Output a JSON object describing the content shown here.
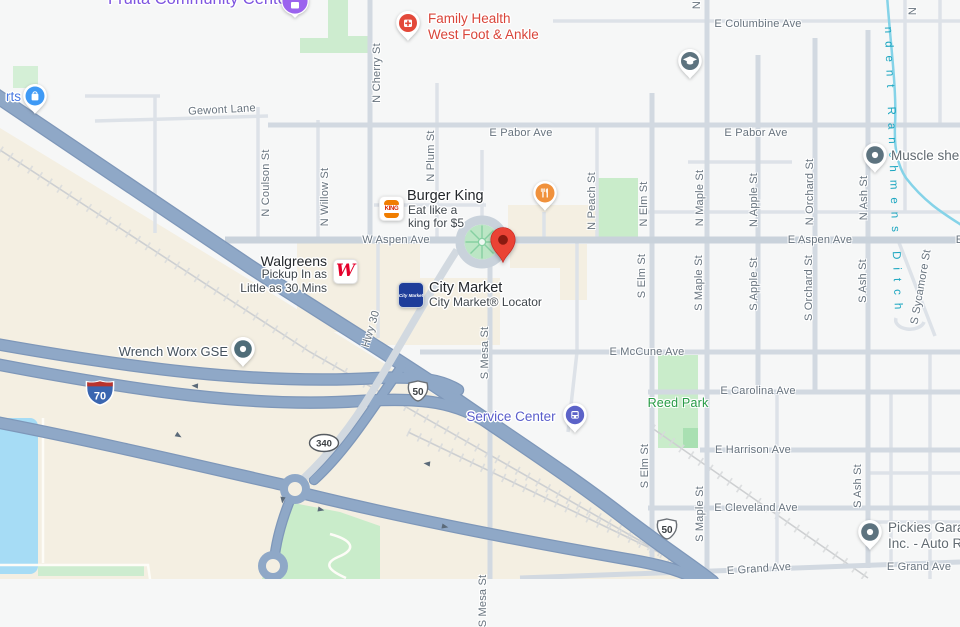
{
  "map": {
    "colors": {
      "destination_pin": "#ea4335",
      "highway": "#8fa8c7",
      "water": "#a6dcf5",
      "park": "#c9ecca",
      "purple_poi": "#7e55e0",
      "red_poi": "#d9453a",
      "transit_poi": "#5a5ecb",
      "park_label": "#279b45",
      "ditch": "#1ba6c0"
    },
    "pois": {
      "fruita": {
        "name": "Fruita Community Center"
      },
      "family_health": {
        "line1": "Family Health",
        "line2": "West Foot & Ankle"
      },
      "muscle": {
        "name": "Muscle she"
      },
      "parts": {
        "name": "rts"
      },
      "burger_king": {
        "name": "Burger King",
        "promo1": "Eat like a",
        "promo2": "king for $5",
        "logo_word": "KING"
      },
      "walgreens": {
        "name": "Walgreens",
        "promo1": "Pickup In as",
        "promo2": "Little as 30 Mins",
        "logo_letter": "W"
      },
      "city_market": {
        "name": "City Market",
        "sub": "City Market® Locator",
        "logo_word": "City Market"
      },
      "wrench": {
        "name": "Wrench Worx GSE"
      },
      "service_center": {
        "name": "Service Center"
      },
      "pickies": {
        "line1": "Pickies Gara",
        "line2": "Inc. - Auto R"
      },
      "reed_park": {
        "name": "Reed Park"
      }
    },
    "shields": {
      "i70": "70",
      "us50": "50",
      "co340": "340"
    },
    "waterway": {
      "name": "ndent Ranchmens Ditch"
    },
    "street_labels": [
      {
        "t": "N Coulson St",
        "x": 266,
        "y": 183
      },
      {
        "t": "N Willow St",
        "x": 325,
        "y": 197
      },
      {
        "t": "N Cherry St",
        "x": 377,
        "y": 73
      },
      {
        "t": "N Plum St",
        "x": 431,
        "y": 156
      },
      {
        "t": "N Peach St",
        "x": 592,
        "y": 201
      },
      {
        "t": "N Elm St",
        "x": 644,
        "y": 204
      },
      {
        "t": "S Elm St",
        "x": 642,
        "y": 276
      },
      {
        "t": "S Elm St",
        "x": 645,
        "y": 466
      },
      {
        "t": "N Maple St",
        "x": 700,
        "y": 198
      },
      {
        "t": "S Maple St",
        "x": 699,
        "y": 283
      },
      {
        "t": "S Maple St",
        "x": 700,
        "y": 514
      },
      {
        "t": "N Apple St",
        "x": 754,
        "y": 200
      },
      {
        "t": "S Apple St",
        "x": 754,
        "y": 284
      },
      {
        "t": "N Orchard St",
        "x": 810,
        "y": 192
      },
      {
        "t": "S Orchard St",
        "x": 809,
        "y": 288
      },
      {
        "t": "N Ash St",
        "x": 864,
        "y": 198
      },
      {
        "t": "S Ash St",
        "x": 863,
        "y": 281
      },
      {
        "t": "S Ash St",
        "x": 858,
        "y": 486
      },
      {
        "t": "S Mesa St",
        "x": 485,
        "y": 353
      },
      {
        "t": "S Mesa St",
        "x": 483,
        "y": 601
      },
      {
        "t": "Hwy 30",
        "x": 371,
        "y": 329,
        "r": -73
      },
      {
        "t": "S Sycamore St",
        "x": 921,
        "y": 287,
        "r": -80
      },
      {
        "t": "N",
        "x": 697,
        "y": 5
      },
      {
        "t": "N",
        "x": 913,
        "y": 11
      }
    ],
    "avenue_labels": [
      {
        "t": "Gewont Lane",
        "x": 222,
        "y": 110,
        "r": -3
      },
      {
        "t": "E Columbine Ave",
        "x": 758,
        "y": 24
      },
      {
        "t": "E Pabor Ave",
        "x": 521,
        "y": 133
      },
      {
        "t": "E Pabor Ave",
        "x": 756,
        "y": 133
      },
      {
        "t": "W Aspen Ave",
        "x": 396,
        "y": 240
      },
      {
        "t": "E Aspen Ave",
        "x": 820,
        "y": 240
      },
      {
        "t": "E Aspen Ave",
        "x": 988,
        "y": 240
      },
      {
        "t": "E McCune Ave",
        "x": 647,
        "y": 352
      },
      {
        "t": "E Carolina Ave",
        "x": 758,
        "y": 391
      },
      {
        "t": "E Harrison Ave",
        "x": 753,
        "y": 450
      },
      {
        "t": "E Cleveland Ave",
        "x": 756,
        "y": 508
      },
      {
        "t": "E Grand Ave",
        "x": 759,
        "y": 569,
        "r": -4
      },
      {
        "t": "E Grand Ave",
        "x": 919,
        "y": 567
      },
      {
        "t": "Reed Park",
        "x": 678,
        "y": 403,
        "c": "park",
        "n": "park-label"
      }
    ]
  }
}
